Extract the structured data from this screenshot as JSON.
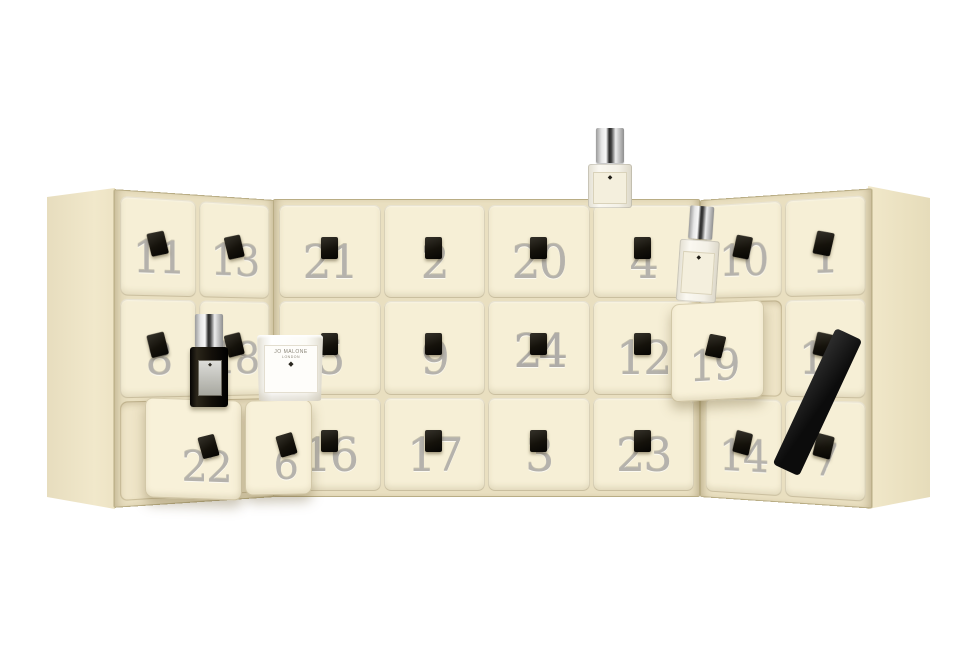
{
  "scene": {
    "kind": "product-photo",
    "subject": "cream advent calendar with 24 numbered drawers, black ribbon pulls, perfume bottles and a candle",
    "background_color": "#ffffff"
  },
  "colors": {
    "box_cream": "#f6efd6",
    "box_side": "#ece2c4",
    "gap_frame": "#e9dfc0",
    "number_silver": "#b5b2ac",
    "pull_black": "#15120b",
    "ribbon_black": "#1a1a1a",
    "glass": "#f3f0e6",
    "label_cream": "#f4efdd",
    "black_bottle": "#14100a",
    "candle_white": "#fdfcf8"
  },
  "panels": {
    "left": {
      "drawers": [
        {
          "number": "11"
        },
        {
          "number": "13"
        },
        {
          "number": "8"
        },
        {
          "number": "18"
        },
        {
          "number": "22",
          "pulled_out": true
        },
        {
          "number": "6",
          "pulled_out": true
        }
      ]
    },
    "center": {
      "drawers": [
        {
          "number": "21"
        },
        {
          "number": "2"
        },
        {
          "number": "20"
        },
        {
          "number": "4"
        },
        {
          "number": "5"
        },
        {
          "number": "9"
        },
        {
          "number": "24",
          "feature": true
        },
        {
          "number": "12"
        },
        {
          "number": "16"
        },
        {
          "number": "17"
        },
        {
          "number": "3"
        },
        {
          "number": "23"
        }
      ]
    },
    "right": {
      "drawers": [
        {
          "number": "10"
        },
        {
          "number": "1"
        },
        {
          "number": "19",
          "pulled_out": true
        },
        {
          "number": "15"
        },
        {
          "number": "14"
        },
        {
          "number": "7"
        }
      ]
    }
  },
  "products": {
    "candle": {
      "label_line1": "JO MALONE",
      "label_line2": "LONDON"
    },
    "logo_glyph": "◆"
  }
}
